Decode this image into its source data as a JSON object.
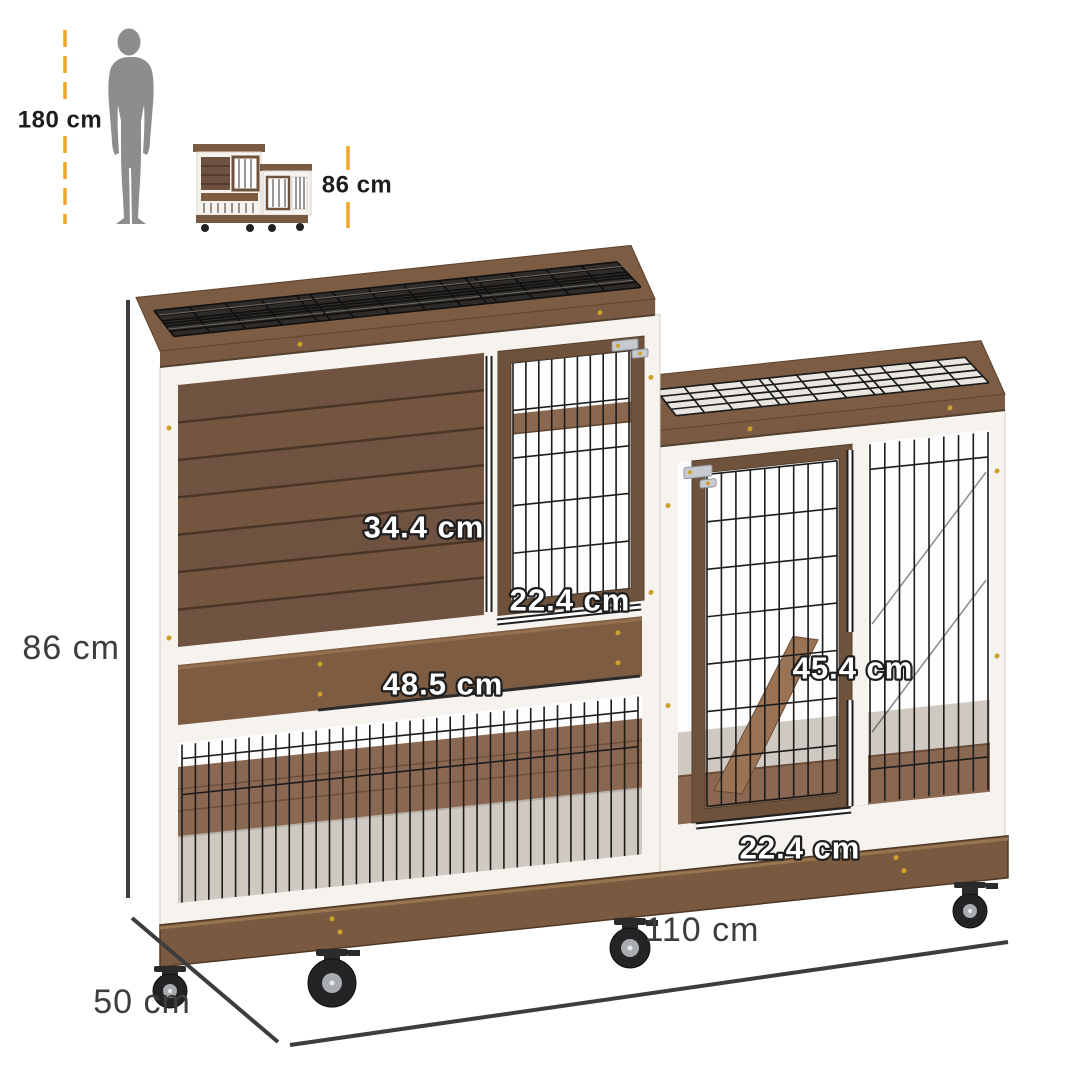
{
  "reference": {
    "human_height_label": "180 cm",
    "product_height_label": "86 cm"
  },
  "dimensions": {
    "overall_height": "86 cm",
    "overall_width": "110 cm",
    "overall_depth": "50 cm",
    "hutch_door_height": "34.4 cm",
    "hutch_door_width": "22.4 cm",
    "pullout_tray_width": "48.5 cm",
    "run_door_height": "45.4 cm",
    "run_door_width": "22.4 cm"
  },
  "colors": {
    "accent_dash": "#F0A62B",
    "dimension_line": "#3D3D3D",
    "label_text_dark": "#1D1D1B",
    "label_text_light": "#FFFFFF",
    "label_outline": "#1F1F1F",
    "silhouette": "#8D8D8D",
    "wood_mid": "#7A5A42",
    "wood_dark": "#5E4430",
    "frame_white": "#F6F3EE",
    "wire": "#1B1B1B"
  }
}
